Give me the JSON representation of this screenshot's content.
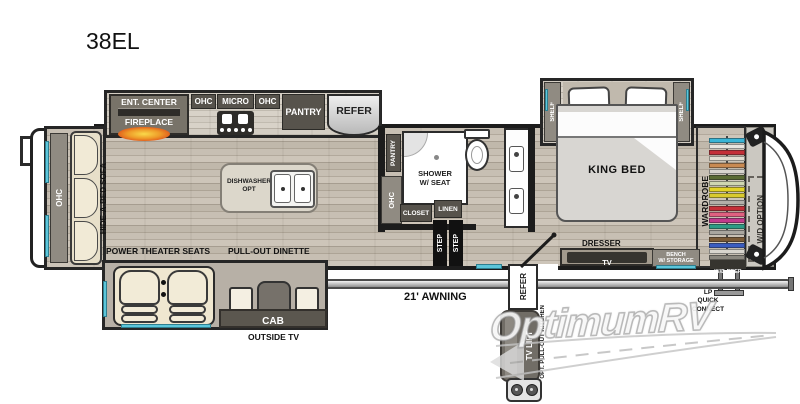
{
  "model": {
    "name": "38EL"
  },
  "colors": {
    "window": "#5cc6da",
    "wall": "#1c1c1c",
    "cabinet_dark": "#57534c",
    "cabinet_gray": "#908b82",
    "flame": "#e8821e",
    "watermark_gray": "#c4c4c4",
    "seat_beige": "#efe7d0"
  },
  "rear": {
    "ohc": "OHC",
    "sofa": "HIDE-A-BED SOFA"
  },
  "kitchen": {
    "ent_center": "ENT. CENTER",
    "fireplace": "FIREPLACE",
    "ohc_left": "OHC",
    "micro": "MICRO",
    "ohc_right": "OHC",
    "pantry": "PANTRY",
    "refer": "REFER",
    "dishwasher_line1": "DISHWASHER",
    "dishwasher_line2": "OPT",
    "wall_pantry": "PANTRY",
    "wall_ohc": "OHC"
  },
  "bath": {
    "shower_line1": "SHOWER",
    "shower_line2": "W/ SEAT",
    "closet": "CLOSET",
    "linen": "LINEN",
    "step_upper": "STEP",
    "step_lower": "STEP"
  },
  "bedroom": {
    "shelf_left": "SHELF",
    "shelf_right": "SHELF",
    "bed": "KING BED",
    "dresser": "DRESSER",
    "tv": "TV",
    "bench_line1": "BENCH",
    "bench_line2": "W/ STORAGE",
    "wardrobe": "WARDROBE",
    "wd_option": "W/D OPTION",
    "wd_prep": "W/D PREP"
  },
  "living": {
    "theater": "POWER THEATER SEATS",
    "dinette": "PULL-OUT DINETTE",
    "cab": "CAB",
    "outside_tv": "OUTSIDE TV"
  },
  "exterior": {
    "awning": "21' AWNING",
    "refer": "REFER",
    "tv_lift": "TV LIFT",
    "opt_kitchen": "OPT. PULL-OUT KITCHEN",
    "lp_line1": "LP",
    "lp_line2": "QUICK",
    "lp_line3": "CONNECT"
  },
  "watermark": {
    "text": "OptimumRV"
  },
  "wardrobe_colors": [
    "#3ab5d6",
    "#e8e6e0",
    "#c43038",
    "#e3ded2",
    "#c98a52",
    "#d8d5ce",
    "#5a6b33",
    "#cfd6b0",
    "#e3d326",
    "#d9ca2e",
    "#b3b0a9",
    "#c43038",
    "#e06080",
    "#c23a8c",
    "#2e9c85",
    "#a9a69f",
    "#7a5a36",
    "#3a5cc0",
    "#d8d5ce",
    "#8a877f"
  ]
}
